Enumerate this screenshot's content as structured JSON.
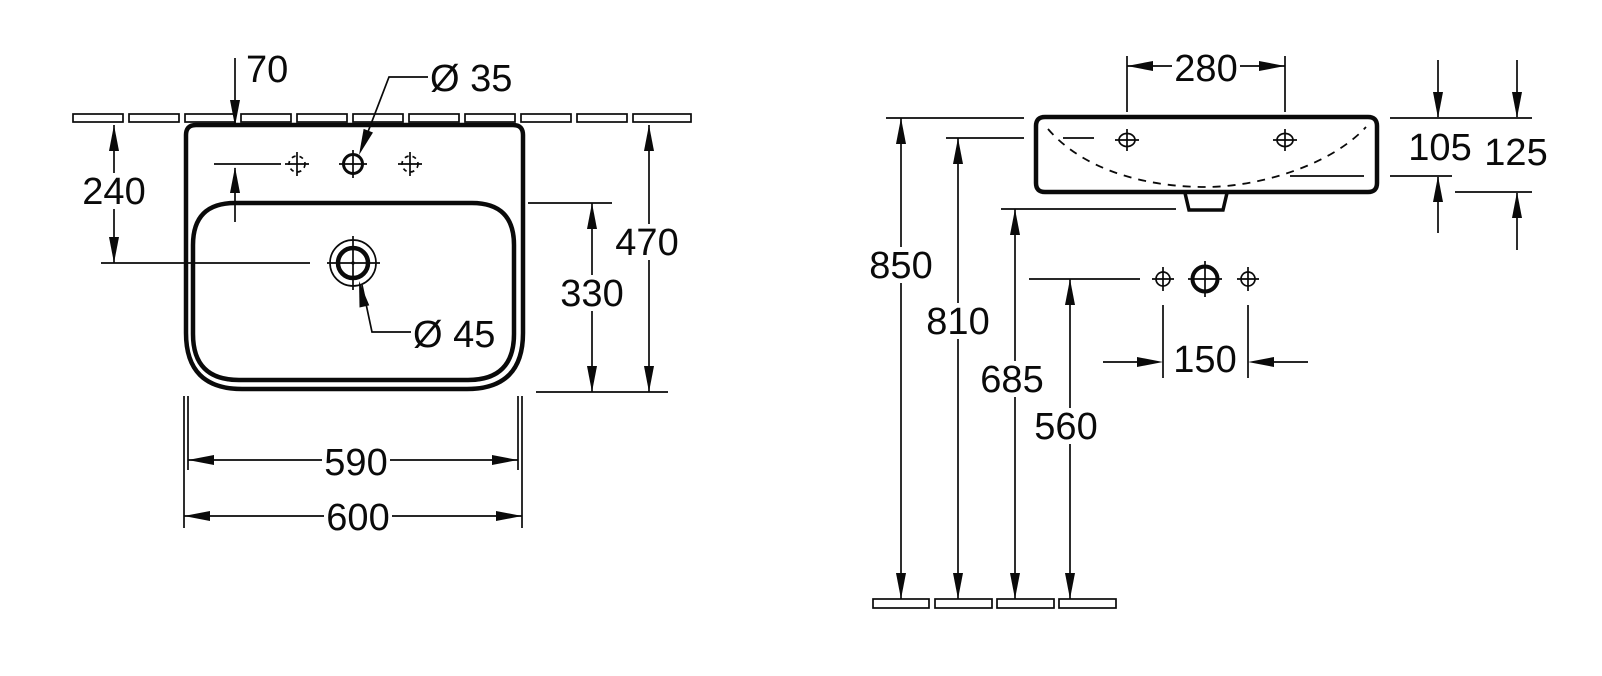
{
  "page": {
    "background_color": "#ffffff",
    "line_color": "#0a0a0a",
    "description": "Washbasin dimensional technical drawing, top view and side view"
  },
  "front_view": {
    "name": "washbasin top view",
    "dims": {
      "tap_hole_offset": "70",
      "tap_hole_diameter": "Ø 35",
      "wall_to_drain": "240",
      "overall_depth": "470",
      "bowl_depth": "330",
      "drain_diameter": "Ø 45",
      "inner_width": "590",
      "overall_width": "600"
    }
  },
  "side_view": {
    "name": "washbasin side view",
    "dims": {
      "fixing_hole_spacing": "280",
      "rim_to_overflow_depth": "105",
      "ceramic_height": "125",
      "rim_height_above_floor": "850",
      "fixing_holes_height": "810",
      "underside_height": "685",
      "outlet_center_height": "560",
      "wall_hole_spacing": "150"
    }
  }
}
